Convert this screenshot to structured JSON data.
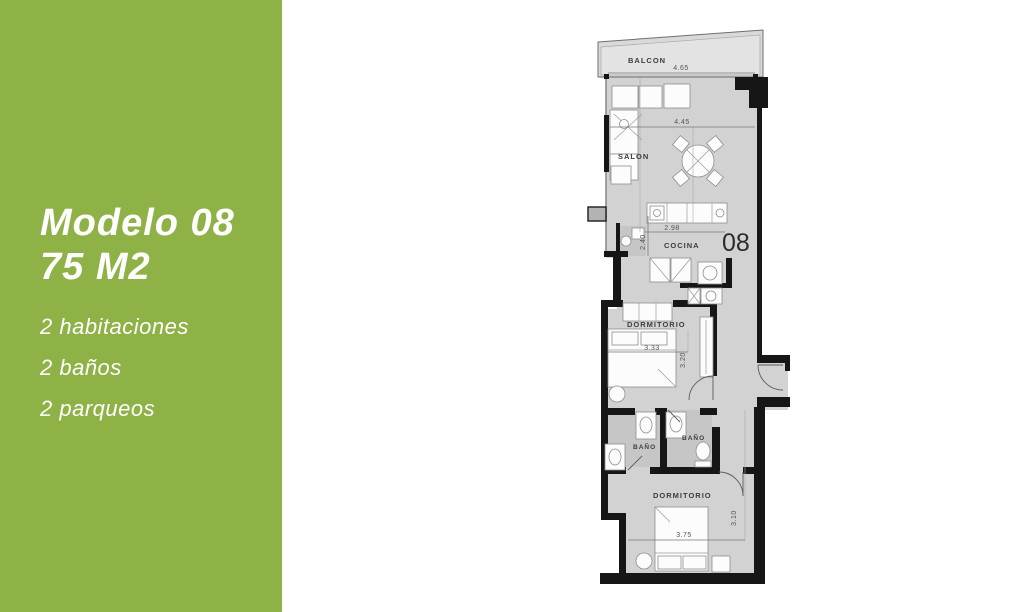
{
  "panel": {
    "title_line1": "Modelo 08",
    "title_line2": "75 M2",
    "features": [
      "2 habitaciones",
      "2 baños",
      "2 parqueos"
    ],
    "accent_color": "#8fb246"
  },
  "floorplan": {
    "unit_number": "08",
    "rooms": {
      "balcon": "BALCON",
      "salon": "SALON",
      "cocina": "COCINA",
      "dormitorio1": "DORMITORIO",
      "bano1": "BAÑO",
      "bano2": "BAÑO",
      "dormitorio2": "DORMITORIO"
    },
    "dimensions": {
      "balcon_width": "4.65",
      "salon_width": "4.45",
      "cocina_width": "2.98",
      "cocina_depth": "2.40",
      "dorm1_width": "3.33",
      "dorm1_depth": "3.20",
      "dorm2_width": "3.75",
      "dorm2_depth": "3.10"
    }
  }
}
